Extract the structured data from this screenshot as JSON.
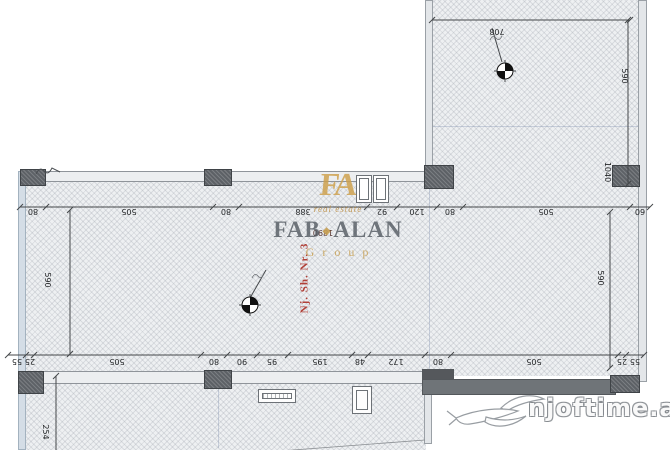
{
  "labels": {
    "unit": "Nj. Sh. Nr. 3"
  },
  "dims": {
    "t708": "708",
    "room590": "590",
    "v1040": "1040",
    "left590": "590",
    "right590": "590",
    "v254": "254",
    "d1890": "1890",
    "top_chain": [
      "80",
      "505",
      "80",
      "388",
      "92",
      "120",
      "80",
      "505",
      "60"
    ],
    "bottom_chain": [
      "55",
      "25",
      "505",
      "80",
      "90",
      "95",
      "195",
      "48",
      "172",
      "80",
      "505",
      "25",
      "55"
    ]
  },
  "logo": {
    "monogram": "FA",
    "script": "real estate",
    "name1": "FAB",
    "diamond": "◆",
    "name2": "ALAN",
    "group": "Group"
  },
  "watermark": {
    "site": "njoftime.al"
  },
  "colors": {
    "gold": "#c8a052",
    "red": "#b04038",
    "wall_dark": "#6f7478",
    "column": "#5d6166"
  }
}
